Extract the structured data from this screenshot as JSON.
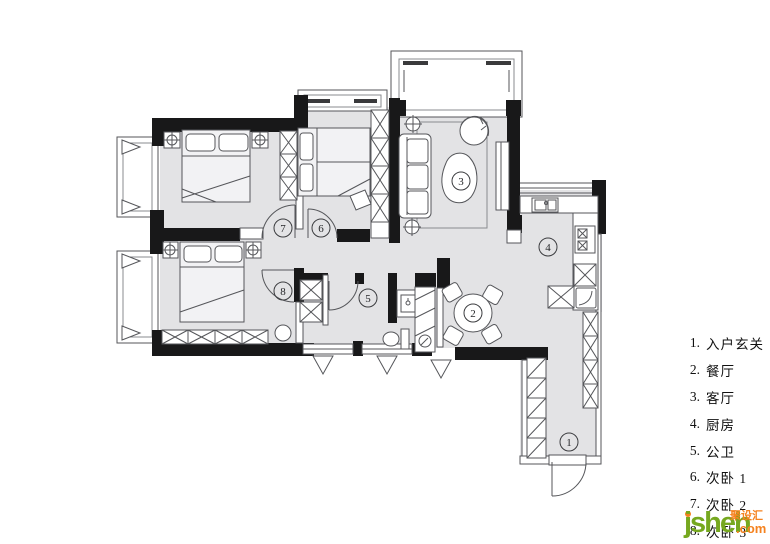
{
  "plan": {
    "markers": [
      "1",
      "2",
      "3",
      "4",
      "5",
      "6",
      "7",
      "8"
    ]
  },
  "legend": {
    "items": [
      {
        "num": "1.",
        "label": "入户玄关"
      },
      {
        "num": "2.",
        "label": "餐厅"
      },
      {
        "num": "3.",
        "label": "客厅"
      },
      {
        "num": "4.",
        "label": "厨房"
      },
      {
        "num": "5.",
        "label": "公卫"
      },
      {
        "num": "6.",
        "label": "次卧 1"
      },
      {
        "num": "7.",
        "label": "次卧 2"
      },
      {
        "num": "8.",
        "label": "次卧 3"
      }
    ]
  },
  "logo": {
    "name": "jsheh",
    "tld": ".com",
    "cn": "聚设汇"
  },
  "colors": {
    "floor_gray": "#e3e3e5",
    "wall_black": "#181819",
    "line_gray": "#55565a",
    "logo_green": "#76a81f",
    "logo_orange": "#f5821f"
  }
}
